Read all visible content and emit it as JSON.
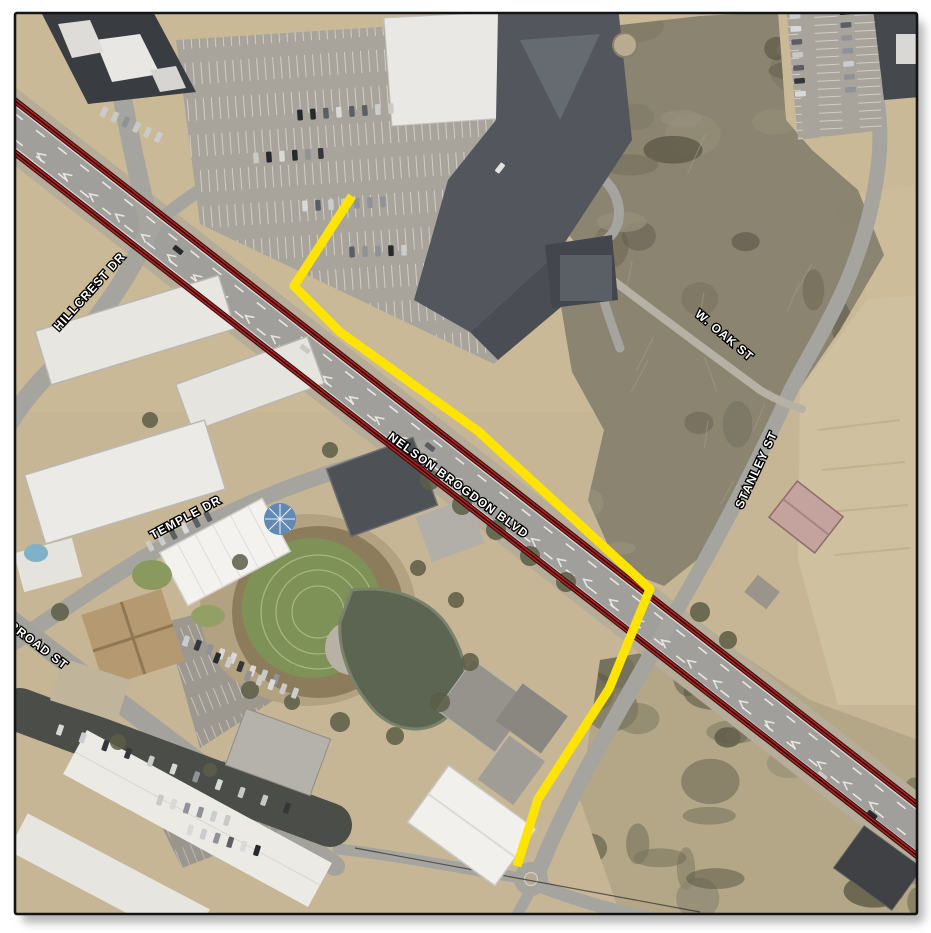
{
  "map": {
    "type": "aerial-orthophoto-exhibit",
    "frame": {
      "border_color": "#141414",
      "page_background": "#ffffff"
    },
    "ground_color": "#c6b695",
    "street_labels": [
      {
        "id": "hillcrest",
        "text": "HILLCREST DR",
        "x": 90,
        "y": 292,
        "rotation": -48
      },
      {
        "id": "temple",
        "text": "TEMPLE DR",
        "x": 186,
        "y": 518,
        "rotation": -28
      },
      {
        "id": "broad",
        "text": "BROAD ST",
        "x": 38,
        "y": 646,
        "rotation": 37
      },
      {
        "id": "nelson-brogdon",
        "text": "NELSON BROGDON BLVD",
        "x": 458,
        "y": 486,
        "rotation": 36
      },
      {
        "id": "w-oak",
        "text": "W. OAK ST",
        "x": 724,
        "y": 336,
        "rotation": 40
      },
      {
        "id": "stanley",
        "text": "STANLEY ST",
        "x": 757,
        "y": 470,
        "rotation": -65
      }
    ],
    "annotations": {
      "highlight_route": {
        "description": "yellow highlighted sidewalk/route",
        "color": "#FFE400",
        "width": 9,
        "points": [
          [
            352,
            196
          ],
          [
            294,
            286
          ],
          [
            340,
            332
          ],
          [
            478,
            431
          ],
          [
            650,
            589
          ],
          [
            609,
            689
          ],
          [
            538,
            799
          ],
          [
            517,
            866
          ]
        ]
      },
      "rail_lines": {
        "description": "double red corridor lines along Nelson Brogdon Blvd",
        "color": "#C41E1E",
        "casing_color": "#2B1111",
        "center_color": "#1D0C0C",
        "lines": [
          {
            "points": [
              [
                14,
                100
              ],
              [
                920,
                807
              ]
            ]
          },
          {
            "points": [
              [
                14,
                152
              ],
              [
                920,
                858
              ]
            ]
          }
        ]
      }
    }
  }
}
